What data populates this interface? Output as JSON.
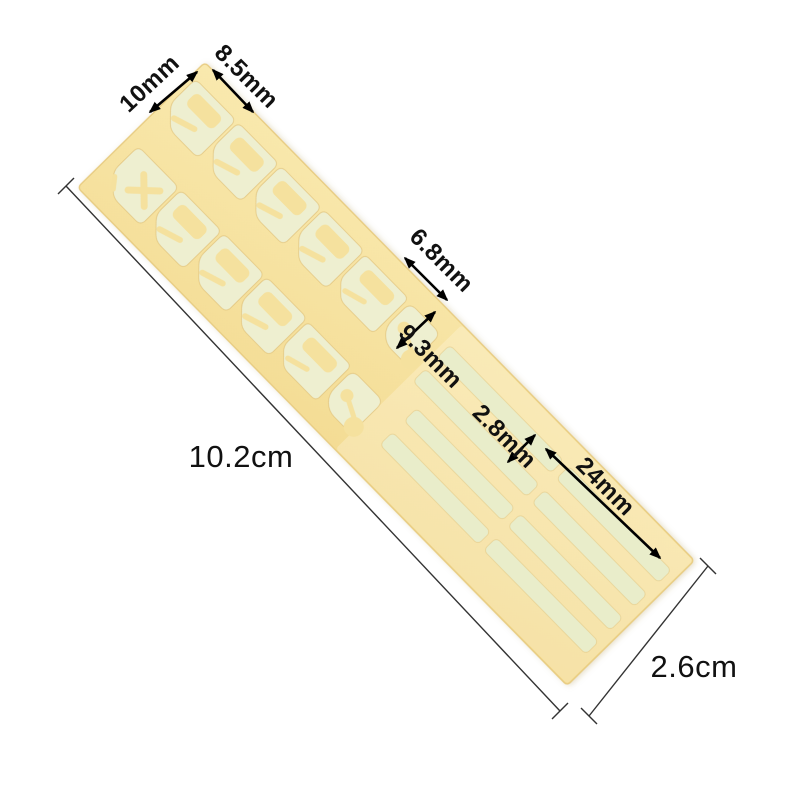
{
  "canvas": {
    "background_color": "#ffffff"
  },
  "sheet": {
    "backing_color_light": "#f9e9ae",
    "backing_color_dark": "#f2d88c",
    "backing_edge_color": "#e8cc82",
    "cutout_color": "#f5e19e",
    "sticker_color": "#eeefd0",
    "strip_color": "#e9edca",
    "cut_edge_color": "#e0c178",
    "columns": 2,
    "shield_rows_per_column": 4,
    "x_tool_stickers": 1,
    "tag_stickers_per_column": 1,
    "lock_stickers_per_column": 1,
    "strip_groups": 2,
    "strips_per_group": 4
  },
  "annotation": {
    "text_color": "#111111",
    "arrow_color": "#000000",
    "line_color": "#333333"
  },
  "dimensions": {
    "column_width": {
      "label": "10mm"
    },
    "shield_height": {
      "label": "8.5mm"
    },
    "lock_height": {
      "label": "6.8mm"
    },
    "tag_length": {
      "label": "9.3mm"
    },
    "strip_width": {
      "label": "2.8mm"
    },
    "strip_length": {
      "label": "24mm"
    },
    "sheet_length": {
      "label": "10.2cm"
    },
    "sheet_width": {
      "label": "2.6cm"
    }
  }
}
